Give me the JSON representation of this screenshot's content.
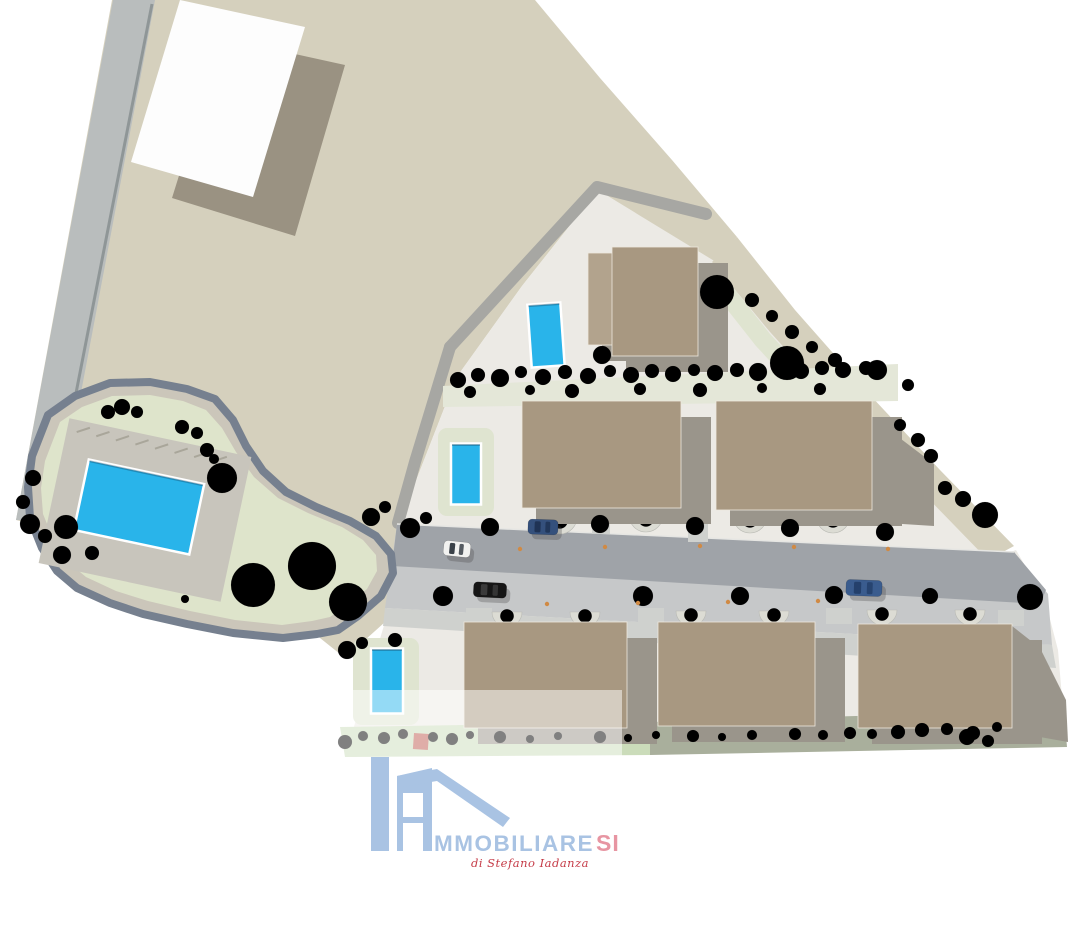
{
  "watermark": {
    "main": "MMOBILIARE",
    "accent": "SI",
    "subtitle": "di Stefano Iadanza"
  },
  "colors": {
    "background": "#FFFFFF",
    "ground_beige": "#D5D0BD",
    "site_ground": "#ECEAE5",
    "perimeter_road": "#A7A7A3",
    "road_dark": "#9FA3A8",
    "road_base": "#C6C8C9",
    "sidewalk": "#CFD1CE",
    "curb": "#E6E6E3",
    "left_road": "#B9BDBD",
    "left_road_edge": "#8F9697",
    "building_tan": "#A89881",
    "building_light": "#B2A38D",
    "building_shadow": "#9A958B",
    "building_edge": "#EDE8DD",
    "white_roof": "#FDFDFD",
    "white_roof_shadow": "#9A9282",
    "pool_water": "#29B4EA",
    "pool_border": "#FFFFFF",
    "grass_loop": "#DEE4CB",
    "grass_pale": "#DFE4D0",
    "hedge_band": "#E4E7D8",
    "strip_light_green": "#CBDCBA",
    "strip_olive": "#A9AF9C",
    "loop_border": "#76808F",
    "loop_track": "#CBC6BA",
    "deck": "#C8C5BC",
    "planter": "#DCDCD4",
    "light_dot": "#D08A44",
    "red_planter": "#BF5B50",
    "logo_blue": "#A9C3E3",
    "logo_pink": "#E795A2",
    "logo_red": "#C53B47"
  },
  "site": {
    "buildings": [
      {
        "x": 588,
        "y": 253,
        "w": 28,
        "h": 92,
        "fill": "light"
      },
      {
        "x": 612,
        "y": 247,
        "w": 86,
        "h": 109,
        "fill": "tan"
      },
      {
        "x": 522,
        "y": 401,
        "w": 159,
        "h": 107,
        "fill": "tan"
      },
      {
        "x": 716,
        "y": 401,
        "w": 156,
        "h": 109,
        "fill": "tan"
      },
      {
        "x": 464,
        "y": 622,
        "w": 163,
        "h": 106,
        "fill": "tan"
      },
      {
        "x": 658,
        "y": 622,
        "w": 157,
        "h": 104,
        "fill": "tan"
      },
      {
        "x": 858,
        "y": 624,
        "w": 154,
        "h": 104,
        "fill": "tan"
      }
    ],
    "extra_shadows": [
      "1012,626 1040,648 1066,700 1068,742 1012,732",
      "872,417 934,464 934,526 872,522"
    ],
    "pools": [
      {
        "cx": 546,
        "cy": 335,
        "w": 33,
        "h": 63,
        "angle": -4
      },
      {
        "cx": 466,
        "cy": 474,
        "w": 30,
        "h": 61,
        "angle": 0,
        "surround": [
          438,
          428,
          56,
          88
        ]
      },
      {
        "cx": 387,
        "cy": 681,
        "w": 32,
        "h": 65,
        "angle": 0,
        "surround": [
          353,
          638,
          66,
          87
        ]
      },
      {
        "cx": 139,
        "cy": 507,
        "w": 118,
        "h": 72,
        "angle": 12
      }
    ],
    "cars": [
      {
        "x": 457,
        "y": 549,
        "w": 27,
        "h": 15,
        "angle": 6,
        "body": "#F2F2F0",
        "roof": "#3A4148"
      },
      {
        "x": 543,
        "y": 527,
        "w": 30,
        "h": 15,
        "angle": 2,
        "body": "#34507C",
        "roof": "#1F3355"
      },
      {
        "x": 490,
        "y": 590,
        "w": 33,
        "h": 15,
        "angle": 3,
        "body": "#161616",
        "roof": "#3A3A3A"
      },
      {
        "x": 864,
        "y": 588,
        "w": 36,
        "h": 16,
        "angle": 2,
        "body": "#3A5C8E",
        "roof": "#24406B"
      }
    ],
    "planters_row_front": [
      [
        560,
        517,
        17
      ],
      [
        646,
        515,
        17
      ],
      [
        750,
        516,
        17
      ],
      [
        833,
        516,
        17
      ]
    ],
    "planters_row_bottom": [
      [
        507,
        612,
        15
      ],
      [
        585,
        612,
        15
      ],
      [
        691,
        611,
        15
      ],
      [
        774,
        611,
        15
      ],
      [
        882,
        610,
        15
      ],
      [
        970,
        610,
        15
      ]
    ],
    "driveways": [
      [
        688,
        506,
        20,
        36
      ],
      [
        592,
        508,
        18,
        26
      ],
      [
        466,
        608,
        26,
        16
      ],
      [
        638,
        608,
        26,
        16
      ],
      [
        826,
        608,
        26,
        16
      ],
      [
        998,
        610,
        26,
        16
      ]
    ],
    "lights": [
      [
        520,
        549
      ],
      [
        605,
        547
      ],
      [
        700,
        546
      ],
      [
        794,
        547
      ],
      [
        888,
        549
      ],
      [
        547,
        604
      ],
      [
        638,
        603
      ],
      [
        728,
        602
      ],
      [
        818,
        601
      ]
    ],
    "red_planter": [
      414,
      733,
      15,
      16
    ],
    "trees": [
      [
        222,
        478,
        15,
        "b"
      ],
      [
        253,
        585,
        22,
        "b"
      ],
      [
        312,
        566,
        24,
        "b"
      ],
      [
        348,
        602,
        19,
        "b"
      ],
      [
        185,
        599,
        4,
        "d"
      ],
      [
        108,
        412,
        7,
        "d"
      ],
      [
        122,
        407,
        8,
        "l"
      ],
      [
        137,
        412,
        6,
        "d"
      ],
      [
        182,
        427,
        7,
        "l"
      ],
      [
        197,
        433,
        6,
        "d"
      ],
      [
        207,
        450,
        7,
        "l"
      ],
      [
        214,
        459,
        5,
        "d"
      ],
      [
        33,
        478,
        8,
        "l"
      ],
      [
        23,
        502,
        7,
        "d"
      ],
      [
        30,
        524,
        10,
        "b"
      ],
      [
        45,
        536,
        7,
        "d"
      ],
      [
        66,
        527,
        12,
        "b"
      ],
      [
        92,
        553,
        7,
        "d"
      ],
      [
        62,
        555,
        9,
        "b"
      ],
      [
        347,
        650,
        9,
        "b"
      ],
      [
        362,
        643,
        6,
        "d"
      ],
      [
        371,
        517,
        9,
        "b"
      ],
      [
        385,
        507,
        6,
        "d"
      ],
      [
        410,
        528,
        10,
        "b"
      ],
      [
        426,
        518,
        6,
        "d"
      ],
      [
        395,
        640,
        7,
        "l"
      ],
      [
        458,
        380,
        8,
        "l"
      ],
      [
        478,
        375,
        7,
        "d"
      ],
      [
        500,
        378,
        9,
        "b"
      ],
      [
        521,
        372,
        6,
        "d"
      ],
      [
        543,
        377,
        8,
        "l"
      ],
      [
        565,
        372,
        7,
        "d"
      ],
      [
        588,
        376,
        8,
        "b"
      ],
      [
        610,
        371,
        6,
        "d"
      ],
      [
        631,
        375,
        8,
        "l"
      ],
      [
        652,
        371,
        7,
        "d"
      ],
      [
        673,
        374,
        8,
        "b"
      ],
      [
        694,
        370,
        6,
        "d"
      ],
      [
        715,
        373,
        8,
        "l"
      ],
      [
        737,
        370,
        7,
        "d"
      ],
      [
        758,
        372,
        9,
        "b"
      ],
      [
        780,
        369,
        6,
        "d"
      ],
      [
        801,
        371,
        8,
        "l"
      ],
      [
        822,
        368,
        7,
        "d"
      ],
      [
        843,
        370,
        8,
        "b"
      ],
      [
        866,
        368,
        7,
        "l"
      ],
      [
        470,
        392,
        6,
        "l"
      ],
      [
        530,
        390,
        5,
        "d"
      ],
      [
        572,
        391,
        7,
        "l"
      ],
      [
        640,
        389,
        6,
        "d"
      ],
      [
        700,
        390,
        7,
        "l"
      ],
      [
        762,
        388,
        5,
        "d"
      ],
      [
        820,
        389,
        6,
        "l"
      ],
      [
        602,
        355,
        9,
        "b"
      ],
      [
        717,
        292,
        17,
        "b"
      ],
      [
        787,
        363,
        17,
        "b"
      ],
      [
        877,
        370,
        10,
        "l"
      ],
      [
        908,
        385,
        6,
        "d"
      ],
      [
        752,
        300,
        7,
        "d"
      ],
      [
        772,
        316,
        6,
        "l"
      ],
      [
        792,
        332,
        7,
        "d"
      ],
      [
        812,
        347,
        6,
        "l"
      ],
      [
        835,
        360,
        7,
        "d"
      ],
      [
        900,
        425,
        6,
        "l"
      ],
      [
        918,
        440,
        7,
        "d"
      ],
      [
        931,
        456,
        7,
        "l"
      ],
      [
        985,
        515,
        13,
        "b"
      ],
      [
        963,
        499,
        8,
        "l"
      ],
      [
        945,
        488,
        7,
        "d"
      ],
      [
        1030,
        597,
        13,
        "b"
      ],
      [
        490,
        527,
        9,
        "b"
      ],
      [
        600,
        524,
        9,
        "b"
      ],
      [
        695,
        526,
        9,
        "b"
      ],
      [
        790,
        528,
        9,
        "b"
      ],
      [
        885,
        532,
        9,
        "b"
      ],
      [
        443,
        596,
        10,
        "b"
      ],
      [
        643,
        596,
        10,
        "b"
      ],
      [
        740,
        596,
        9,
        "b"
      ],
      [
        834,
        595,
        9,
        "b"
      ],
      [
        930,
        596,
        8,
        "l"
      ],
      [
        345,
        742,
        7,
        "b"
      ],
      [
        363,
        736,
        5,
        "d"
      ],
      [
        384,
        738,
        6,
        "l"
      ],
      [
        403,
        734,
        5,
        "d"
      ],
      [
        433,
        737,
        5,
        "l"
      ],
      [
        452,
        739,
        6,
        "b"
      ],
      [
        470,
        735,
        4,
        "l"
      ],
      [
        500,
        737,
        6,
        "d"
      ],
      [
        530,
        739,
        4,
        "l"
      ],
      [
        558,
        736,
        4,
        "l"
      ],
      [
        600,
        737,
        6,
        "d"
      ],
      [
        628,
        738,
        4,
        "l"
      ],
      [
        656,
        735,
        4,
        "b"
      ],
      [
        693,
        736,
        6,
        "d"
      ],
      [
        722,
        737,
        4,
        "l"
      ],
      [
        752,
        735,
        5,
        "b"
      ],
      [
        795,
        734,
        6,
        "d"
      ],
      [
        823,
        735,
        5,
        "l"
      ],
      [
        850,
        733,
        6,
        "b"
      ],
      [
        872,
        734,
        5,
        "d"
      ],
      [
        898,
        732,
        7,
        "b"
      ],
      [
        922,
        730,
        7,
        "b"
      ],
      [
        947,
        729,
        6,
        "d"
      ],
      [
        973,
        733,
        7,
        "b"
      ],
      [
        997,
        727,
        5,
        "l"
      ],
      [
        967,
        737,
        8,
        "b"
      ],
      [
        988,
        741,
        6,
        "b"
      ]
    ]
  }
}
